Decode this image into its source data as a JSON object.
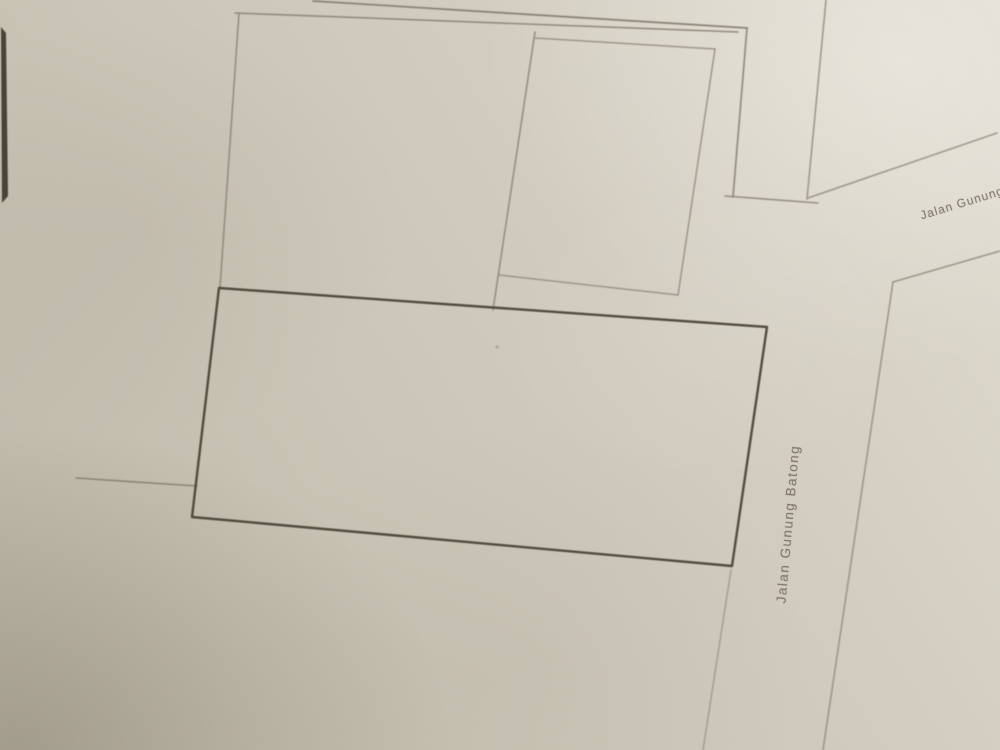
{
  "map": {
    "description_colors": {
      "paper_base": "#d0cabd",
      "paper_highlight": "#dfdbd0",
      "paper_shadow": "#bdb7a8",
      "faint_line": "#8b8477",
      "dark_outline": "#4a4437",
      "photo_edge": "#3e382d",
      "label_text": "#7a7063"
    },
    "labels": [
      {
        "name": "street-label-jalan-gunung-batong",
        "text": "Jalan Gunung Batong",
        "x": 788,
        "y": 524,
        "rotation": -85,
        "class": "vertical"
      },
      {
        "name": "street-label-jalan-gunung",
        "text": "Jalan Gunung",
        "x": 962,
        "y": 203,
        "rotation": -17,
        "class": "diagonal"
      }
    ],
    "shapes": [
      {
        "name": "photo-edge-strip",
        "type": "polygon",
        "points": [
          [
            1,
            27
          ],
          [
            6,
            33
          ],
          [
            8,
            196
          ],
          [
            2,
            203
          ]
        ],
        "fill": "#3e382d",
        "stroke": "none",
        "width": 0,
        "opacity": 0.92
      },
      {
        "name": "top-road-edge-upper",
        "type": "line",
        "points": [
          [
            313,
            1
          ],
          [
            747,
            28
          ]
        ],
        "stroke": "#837c6e",
        "width": 1.8,
        "opacity": 0.9
      },
      {
        "name": "top-road-edge-lower",
        "type": "line",
        "points": [
          [
            235,
            13
          ],
          [
            738,
            32
          ]
        ],
        "stroke": "#8b8477",
        "width": 1.6,
        "opacity": 0.9
      },
      {
        "name": "left-parcel-west-edge",
        "type": "line",
        "points": [
          [
            239,
            13
          ],
          [
            220,
            288
          ]
        ],
        "stroke": "#8b8477",
        "width": 1.6,
        "opacity": 0.85
      },
      {
        "name": "parcel-divider",
        "type": "line",
        "points": [
          [
            535,
            32
          ],
          [
            493,
            310
          ]
        ],
        "stroke": "#8b8477",
        "width": 1.6,
        "opacity": 0.85
      },
      {
        "name": "right-parcel-north-edge",
        "type": "line",
        "points": [
          [
            535,
            38
          ],
          [
            715,
            49
          ]
        ],
        "stroke": "#938c7e",
        "width": 1.5,
        "opacity": 0.85
      },
      {
        "name": "right-parcel-east-edge",
        "type": "line",
        "points": [
          [
            715,
            49
          ],
          [
            678,
            295
          ]
        ],
        "stroke": "#938c7e",
        "width": 1.5,
        "opacity": 0.85
      },
      {
        "name": "right-parcel-south-edge",
        "type": "line",
        "points": [
          [
            499,
            275
          ],
          [
            678,
            295
          ]
        ],
        "stroke": "#938c7e",
        "width": 1.5,
        "opacity": 0.85
      },
      {
        "name": "block-corner-east-edge",
        "type": "line",
        "points": [
          [
            747,
            28
          ],
          [
            733,
            197
          ]
        ],
        "stroke": "#8b8477",
        "width": 1.7,
        "opacity": 0.9
      },
      {
        "name": "junction-boundary",
        "type": "line",
        "points": [
          [
            725,
            196
          ],
          [
            818,
            203
          ]
        ],
        "stroke": "#8b8477",
        "width": 1.6,
        "opacity": 0.85
      },
      {
        "name": "road-east-edge-upper",
        "type": "line",
        "points": [
          [
            826,
            0
          ],
          [
            807,
            199
          ]
        ],
        "stroke": "#948d80",
        "width": 1.6,
        "opacity": 0.85
      },
      {
        "name": "diagonal-road-north-edge",
        "type": "line",
        "points": [
          [
            808,
            198
          ],
          [
            997,
            133
          ]
        ],
        "stroke": "#948d80",
        "width": 1.6,
        "opacity": 0.85
      },
      {
        "name": "diagonal-road-south-edge",
        "type": "line",
        "points": [
          [
            1000,
            251
          ],
          [
            893,
            282
          ]
        ],
        "stroke": "#948d80",
        "width": 1.6,
        "opacity": 0.85
      },
      {
        "name": "road-east-edge-lower",
        "type": "line",
        "points": [
          [
            893,
            282
          ],
          [
            823,
            750
          ]
        ],
        "stroke": "#948d80",
        "width": 1.6,
        "opacity": 0.85
      },
      {
        "name": "road-west-edge-lower",
        "type": "line",
        "points": [
          [
            731,
            570
          ],
          [
            703,
            750
          ]
        ],
        "stroke": "#9a9386",
        "width": 1.5,
        "opacity": 0.8
      },
      {
        "name": "west-boundary-stub",
        "type": "line",
        "points": [
          [
            76,
            478
          ],
          [
            197,
            486
          ]
        ],
        "stroke": "#868071",
        "width": 1.6,
        "opacity": 0.9
      },
      {
        "name": "main-parcel-outline",
        "type": "polygon",
        "points": [
          [
            219,
            288
          ],
          [
            767,
            327
          ],
          [
            732,
            566
          ],
          [
            192,
            517
          ]
        ],
        "fill": "none",
        "stroke": "#4a4437",
        "width": 2.4,
        "opacity": 0.95
      },
      {
        "name": "paper-speck",
        "type": "circle",
        "cx": 497,
        "cy": 347,
        "r": 1.6,
        "fill": "#a59d8d",
        "stroke": "none",
        "width": 0,
        "opacity": 0.8
      }
    ]
  }
}
